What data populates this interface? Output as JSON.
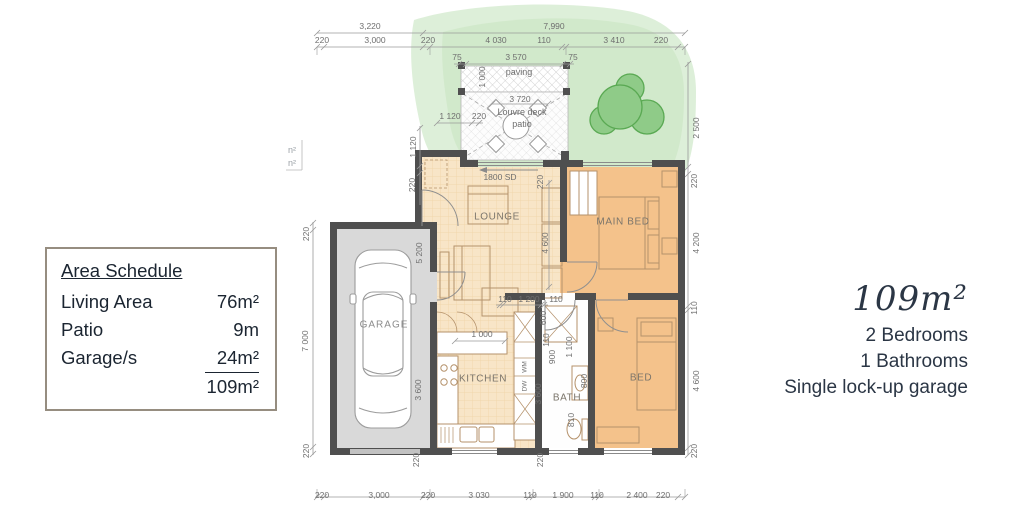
{
  "area_schedule": {
    "title": "Area Schedule",
    "rows": [
      {
        "label": "Living Area",
        "value": "76m²"
      },
      {
        "label": "Patio",
        "value": "9m"
      },
      {
        "label": "Garage/s",
        "value": "24m²"
      },
      {
        "label": "",
        "value": "109m²"
      }
    ]
  },
  "summary": {
    "area": "109m²",
    "bedrooms": "2 Bedrooms",
    "bathrooms": "1 Bathrooms",
    "garage": "Single lock-up garage"
  },
  "plan": {
    "rooms": {
      "garage": "GARAGE",
      "lounge": "LOUNGE",
      "main_bed": "MAIN BED",
      "kitchen": "KITCHEN",
      "bath": "BATH",
      "bed": "BED"
    },
    "patio": {
      "deck_line1": "Louvre deck",
      "deck_line2": "patio",
      "paving": "paving",
      "slider": "1800 SD"
    },
    "legend": {
      "line1": "n²",
      "line2": "n²"
    },
    "appliances": {
      "wm": "WM",
      "dw": "DW"
    },
    "dims": {
      "top1": [
        "3,220",
        "7,990"
      ],
      "top2": [
        "220",
        "3,000",
        "220",
        "4 030",
        "110",
        "3 410",
        "220"
      ],
      "paving_row": [
        "75",
        "3 570",
        "75"
      ],
      "paving_depth": "1 000",
      "patio_width": "3 720",
      "entry_top": [
        "1 120",
        "220"
      ],
      "entry_left": [
        "1 120",
        "220"
      ],
      "left": [
        "220",
        "7 000",
        "220"
      ],
      "right": [
        "2 500",
        "220",
        "4 200",
        "110",
        "4 600",
        "220"
      ],
      "garage_inner": [
        "5 200",
        "3 600"
      ],
      "lounge": [
        "220",
        "4 600"
      ],
      "hall": [
        "110",
        "1 200",
        "110"
      ],
      "wet": [
        "600",
        "110",
        "900",
        "1 100",
        "800",
        "3 600",
        "810"
      ],
      "kitchen_dim": "1 000",
      "bottom_wall": [
        "220",
        "220"
      ],
      "bottom": [
        "220",
        "3,000",
        "220",
        "3 030",
        "110",
        "1 900",
        "110",
        "2 400",
        "220"
      ]
    }
  },
  "colors": {
    "living_floor": "#f8e5c7",
    "bedroom_floor": "#f4c28b",
    "garage_floor": "#d9d9d9",
    "wall": "#4f4f4f",
    "landscape": "#ddefd9",
    "tree": "#8fcb88",
    "text_dark": "#1b2531",
    "summary_text": "#2b3645"
  }
}
